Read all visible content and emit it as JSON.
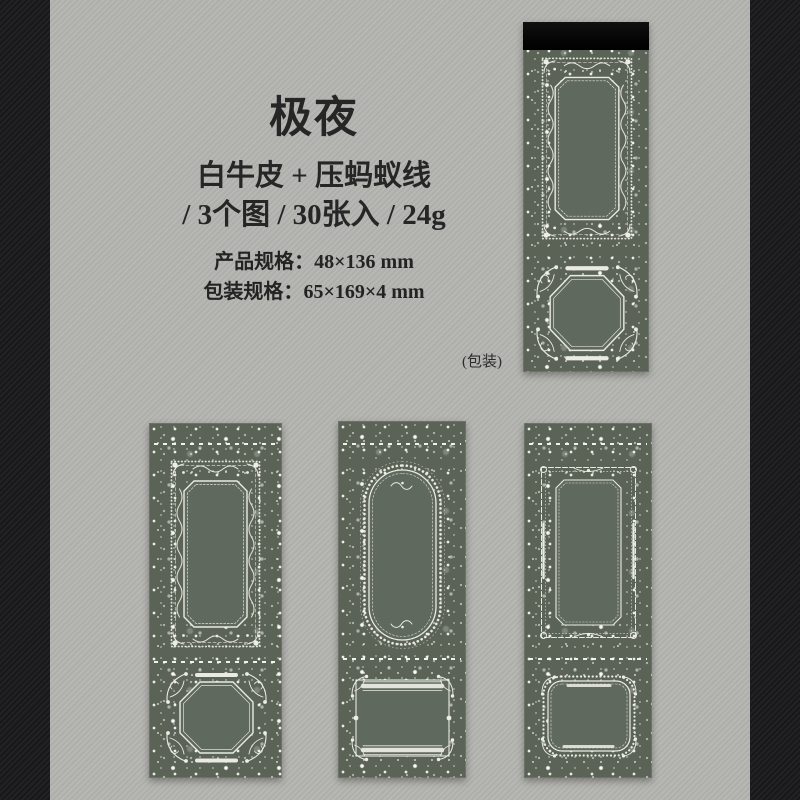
{
  "product": {
    "title": "极夜",
    "material_line": "白牛皮 + 压蚂蚁线",
    "quantity_line": "/ 3个图 / 30张入 / 24g",
    "specs": [
      {
        "label": "产品规格：",
        "value": "48×136 mm"
      },
      {
        "label": "包装规格：",
        "value": "65×169×4 mm"
      }
    ],
    "package_caption": "(包装)"
  },
  "colors": {
    "background": "#b2b2ae",
    "side_bars": "#1c1c1e",
    "pad_body": "#5b6356",
    "pad_panel": "#60695d",
    "frame_ink": "#e9eae2",
    "binding_tape": "#0a0a0a",
    "text": "#262626"
  }
}
